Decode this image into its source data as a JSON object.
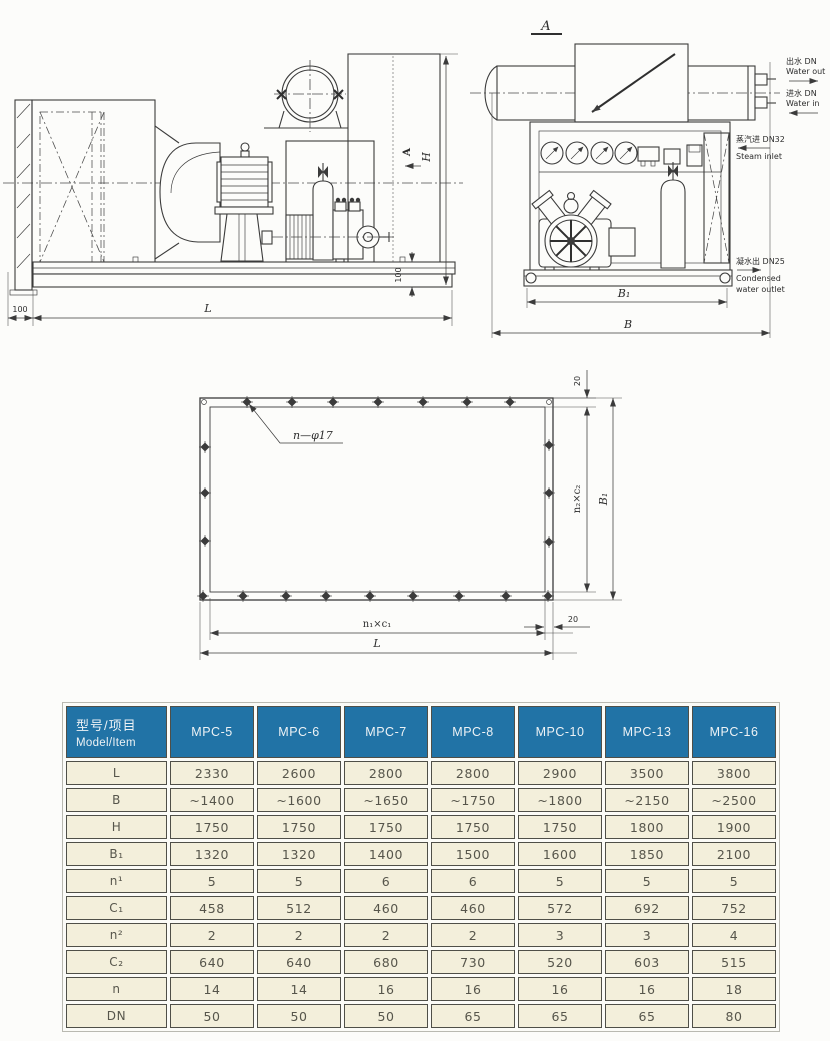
{
  "colors": {
    "header_bg": "#2173a6",
    "header_text": "#edf2f5",
    "cell_bg": "#f3efdb",
    "cell_border": "#4f4f48",
    "line": "#3b3b3b",
    "page_bg": "#fcfcfa"
  },
  "side_view": {
    "dims": {
      "offset_100": "100",
      "length": "L",
      "height": "H",
      "base_100": "100",
      "view_arrow": "A"
    }
  },
  "section_view": {
    "title": "A",
    "ports": {
      "water_out_cn": "出水 DN",
      "water_out_en": "Water out",
      "water_in_cn": "进水 DN",
      "water_in_en": "Water in",
      "steam_cn": "蒸汽进 DN32",
      "steam_en": "Steam inlet",
      "cond_cn": "凝水出 DN25",
      "cond_en1": "Condensed",
      "cond_en2": "water outlet"
    },
    "dims": {
      "b1": "B₁",
      "b": "B"
    }
  },
  "plan_view": {
    "holes_label": "n—φ17",
    "dims": {
      "top_offset": "20",
      "n2c2": "n₂×c₂",
      "b1": "B₁",
      "n1c1": "n₁×c₁",
      "length": "L",
      "side_offset": "20"
    }
  },
  "table": {
    "header": {
      "item_cn": "型号/项目",
      "item_en": "Model/Item"
    },
    "models": [
      "MPC-5",
      "MPC-6",
      "MPC-7",
      "MPC-8",
      "MPC-10",
      "MPC-13",
      "MPC-16"
    ],
    "rows": [
      {
        "label": "L",
        "values": [
          "2330",
          "2600",
          "2800",
          "2800",
          "2900",
          "3500",
          "3800"
        ]
      },
      {
        "label": "B",
        "values": [
          "~1400",
          "~1600",
          "~1650",
          "~1750",
          "~1800",
          "~2150",
          "~2500"
        ]
      },
      {
        "label": "H",
        "values": [
          "1750",
          "1750",
          "1750",
          "1750",
          "1750",
          "1800",
          "1900"
        ]
      },
      {
        "label": "B₁",
        "values": [
          "1320",
          "1320",
          "1400",
          "1500",
          "1600",
          "1850",
          "2100"
        ]
      },
      {
        "label": "n¹",
        "values": [
          "5",
          "5",
          "6",
          "6",
          "5",
          "5",
          "5"
        ]
      },
      {
        "label": "C₁",
        "values": [
          "458",
          "512",
          "460",
          "460",
          "572",
          "692",
          "752"
        ]
      },
      {
        "label": "n²",
        "values": [
          "2",
          "2",
          "2",
          "2",
          "3",
          "3",
          "4"
        ]
      },
      {
        "label": "C₂",
        "values": [
          "640",
          "640",
          "680",
          "730",
          "520",
          "603",
          "515"
        ]
      },
      {
        "label": "n",
        "values": [
          "14",
          "14",
          "16",
          "16",
          "16",
          "16",
          "18"
        ]
      },
      {
        "label": "DN",
        "values": [
          "50",
          "50",
          "50",
          "65",
          "65",
          "65",
          "80"
        ]
      }
    ]
  }
}
